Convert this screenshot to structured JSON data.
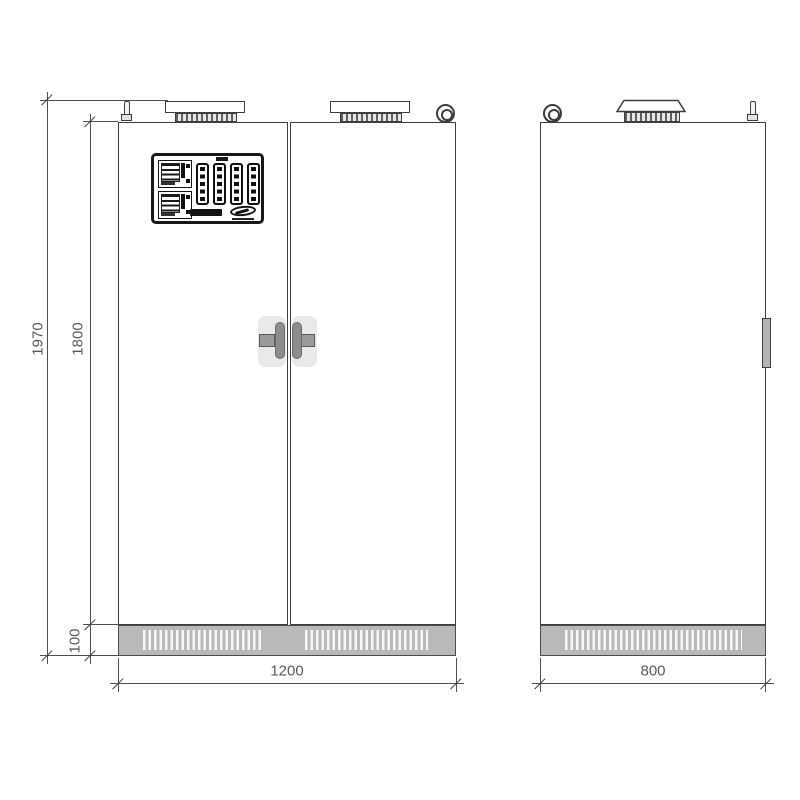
{
  "drawing": {
    "kind": "technical elevation drawing",
    "subject": "double-door electrical cabinet, front and side views"
  },
  "dimensions": {
    "total_height_mm": "1970",
    "body_height_mm": "1800",
    "plinth_height_mm": "100",
    "front_width_mm": "1200",
    "side_depth_mm": "800"
  },
  "components": {
    "front_view": [
      "roof-fan-left",
      "roof-fan-right",
      "lifting-eye",
      "earth-pin",
      "control-panel",
      "door-handles",
      "ventilated-plinth"
    ],
    "side_view": [
      "lifting-eye",
      "roof-fan-cowl",
      "earth-pin",
      "side-handle",
      "ventilated-plinth"
    ],
    "control_panel": [
      "meter-module-top",
      "meter-module-bottom",
      "bargraph-display-1",
      "bargraph-display-2",
      "bargraph-display-3",
      "bargraph-display-4",
      "brand-logo-left",
      "brand-logo-right"
    ]
  },
  "colors": {
    "background": "#ffffff",
    "line": "#3d3d3d",
    "dimension_text": "#595959",
    "plinth_fill": "#b9b9b9",
    "handle_fill": "#8d8d8d",
    "escutcheon_fill": "#e9e9e9",
    "panel_border": "#181818"
  }
}
